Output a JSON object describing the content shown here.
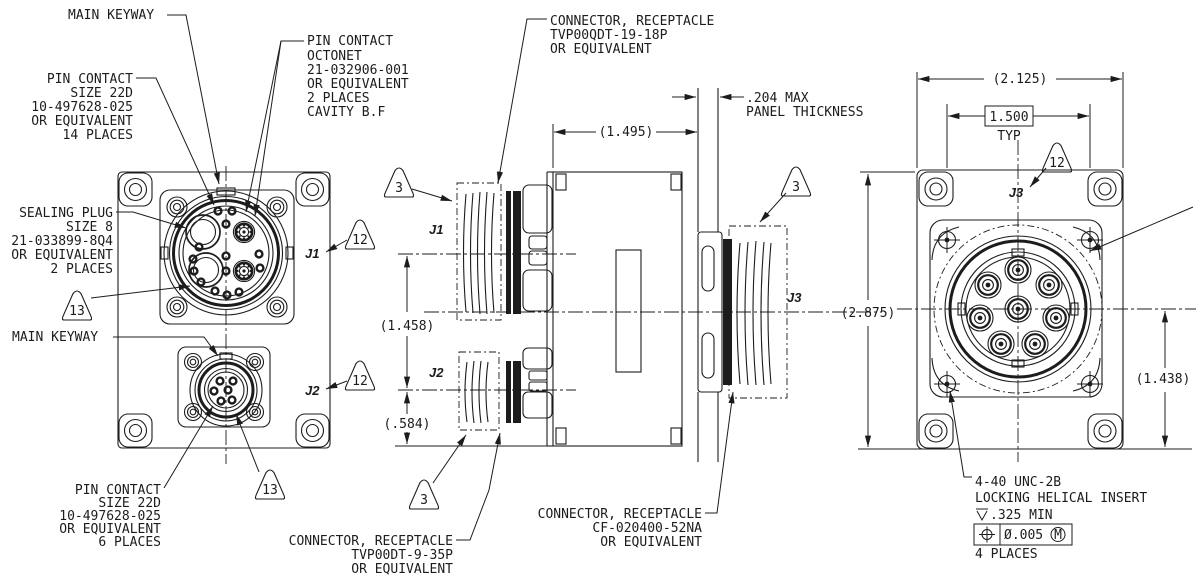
{
  "callouts": {
    "main_keyway_top": "MAIN KEYWAY",
    "pin_contact_14": {
      "l1": "PIN CONTACT",
      "l2": "SIZE 22D",
      "l3": "10-497628-025",
      "l4": "OR EQUIVALENT",
      "l5": "14 PLACES"
    },
    "pin_contact_octonet": {
      "l1": "PIN CONTACT",
      "l2": "OCTONET",
      "l3": "21-032906-001",
      "l4": "OR EQUIVALENT",
      "l5": "2 PLACES",
      "l6": "CAVITY B.F"
    },
    "sealing_plug": {
      "l1": "SEALING PLUG",
      "l2": "SIZE 8",
      "l3": "21-033899-8Q4",
      "l4": "OR EQUIVALENT",
      "l5": "2 PLACES"
    },
    "main_keyway_bottom": "MAIN KEYWAY",
    "pin_contact_6": {
      "l1": "PIN CONTACT",
      "l2": "SIZE 22D",
      "l3": "10-497628-025",
      "l4": "OR EQUIVALENT",
      "l5": "6 PLACES"
    },
    "receptacle_j1": {
      "l1": "CONNECTOR, RECEPTACLE",
      "l2": "TVP00QDT-19-18P",
      "l3": "OR EQUIVALENT"
    },
    "receptacle_j2": {
      "l1": "CONNECTOR, RECEPTACLE",
      "l2": "TVP00DT-9-35P",
      "l3": "OR EQUIVALENT"
    },
    "receptacle_j3": {
      "l1": "CONNECTOR, RECEPTACLE",
      "l2": "CF-020400-52NA",
      "l3": "OR EQUIVALENT"
    },
    "panel": {
      "l1": ".204 MAX",
      "l2": "PANEL THICKNESS"
    },
    "insert_note": {
      "l1": "4-40 UNC-2B",
      "l2": "LOCKING HELICAL INSERT",
      "depth_value": ".325 MIN",
      "fcf_tolerance": "Ø.005",
      "fcf_modifier": "M",
      "places": "4 PLACES"
    }
  },
  "dimensions": {
    "body_width": "(1.495)",
    "j1_j2_spacing": "(1.458)",
    "j2_base": "(.584)",
    "flange_width": "(2.125)",
    "hole_pattern": "1.500",
    "hole_pattern_typ": "TYP",
    "flange_height": "(2.875)",
    "j3_center_height": "(1.438)"
  },
  "labels": {
    "j1": "J1",
    "j2": "J2",
    "j3": "J3"
  },
  "flags": {
    "mating_plug": "3",
    "id_marking": "12",
    "sealing": "13"
  }
}
